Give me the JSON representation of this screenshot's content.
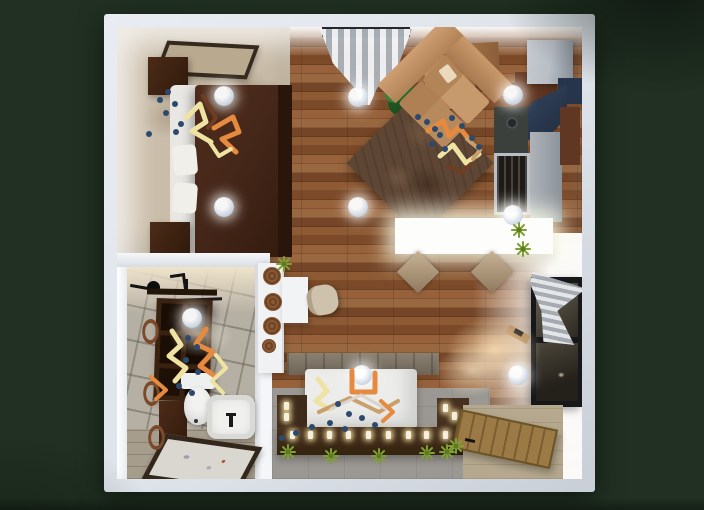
{
  "app": {
    "title": "3D apartment floor plan - top-down render"
  },
  "scene": {
    "view": "top-down-3d-floorplan",
    "ceiling_lights_count": 9,
    "rooms": [
      {
        "id": "bedroom",
        "items": [
          "wall-picture",
          "wardrobe",
          "double-bed",
          "pillows",
          "nightstand",
          "beige-carpet",
          "decor-zigzags"
        ]
      },
      {
        "id": "living-kitchen",
        "items": [
          "window-curtain",
          "potted-plant",
          "tan-dresser",
          "corner-sofa",
          "brown-area-rug",
          "fridge",
          "range-hood",
          "stove",
          "dark-counter",
          "lower-cabinet",
          "white-island-table",
          "two-chairs",
          "small-plants"
        ]
      },
      {
        "id": "bathroom",
        "items": [
          "towel-rail",
          "cubby-shelf",
          "tall-cabinet",
          "towel-rings",
          "toilet",
          "bathtub",
          "framed-floor-mat",
          "decor-zigzags"
        ]
      },
      {
        "id": "second-bedroom",
        "items": [
          "stone-headboard",
          "white-platform-bed",
          "candle-ledge",
          "plants",
          "wall-window",
          "striped-curtain",
          "sconce-shelf"
        ]
      },
      {
        "id": "entry",
        "items": [
          "open-wooden-door",
          "beige-entry-tile"
        ]
      },
      {
        "id": "work-nook",
        "items": [
          "white-console",
          "round-baskets",
          "desk",
          "chair",
          "plant"
        ]
      }
    ]
  },
  "palette": {
    "background": "#213022",
    "wall_outer": "#dce1e8",
    "wall_face": "#f3f5f7",
    "wood": "#8a5430",
    "carpet": "#c9bca8",
    "tile": "#b6b0a4",
    "concrete": "#9b9792",
    "rug": "#5e4635",
    "sofa": "#c79a6e",
    "bed1_duvet": "#46281a",
    "dark_wood": "#3a2212",
    "white_furniture": "#f0f1f2",
    "steel": "#b9bfc6",
    "navy": "#2c3b52",
    "curtain": "#e6e8eb",
    "curtain_stripe": "#aab0b8",
    "plant_green": "#2f7a33",
    "tuft_green": "#7fa032",
    "decor_orange": "#e58a3e",
    "decor_yellow": "#efe3a4",
    "decor_tan": "#c9a06b",
    "decor_brown": "#6e3d22",
    "dot_navy": "#2c4a6e",
    "light_fill": "#cdd9e6",
    "candle_glow": "#ffe9b0"
  }
}
